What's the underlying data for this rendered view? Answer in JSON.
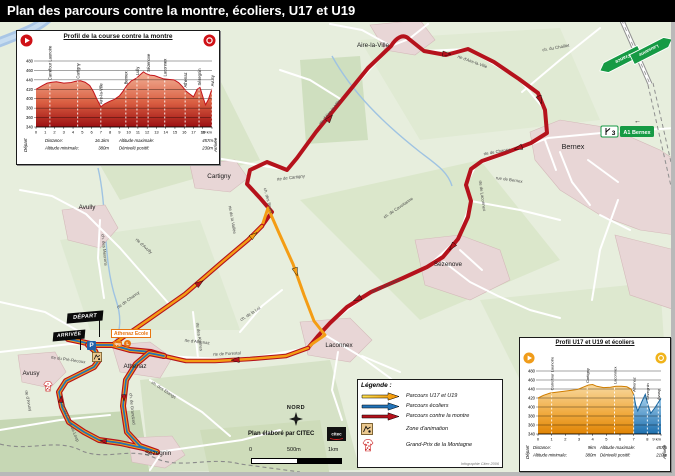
{
  "title": "Plan des parcours contre la montre, écoliers, U17 et U19",
  "colors": {
    "route_red": "#b5121c",
    "route_orange": "#f49d15",
    "route_blue": "#2273b8",
    "sign_green": "#169a44",
    "village_fill": "#e8d6d6",
    "water": "#a9c6e6"
  },
  "map": {
    "villages": [
      {
        "name": "Aire-la-Ville",
        "x": 373,
        "y": 47
      },
      {
        "name": "Bernex",
        "x": 573,
        "y": 149,
        "size": 7.2
      },
      {
        "name": "Cartigny",
        "x": 219,
        "y": 178
      },
      {
        "name": "Avully",
        "x": 87,
        "y": 209
      },
      {
        "name": "Sézenove",
        "x": 448,
        "y": 266
      },
      {
        "name": "Laconnex",
        "x": 339,
        "y": 347
      },
      {
        "name": "Athenaz",
        "x": 135,
        "y": 368
      },
      {
        "name": "Avusy",
        "x": 31,
        "y": 375
      },
      {
        "name": "Sézegnin",
        "x": 158,
        "y": 455
      }
    ],
    "road_labels": [
      {
        "text": "rte d'Aire-la-Ville",
        "x": 331,
        "y": 113,
        "rot": -50
      },
      {
        "text": "rte d'Aire-la-Ville",
        "x": 472,
        "y": 63,
        "rot": 20
      },
      {
        "text": "ch. du Chaillet",
        "x": 556,
        "y": 49,
        "rot": -10
      },
      {
        "text": "rte de Chancy",
        "x": 497,
        "y": 153,
        "rot": -10
      },
      {
        "text": "rue de Bernex",
        "x": 509,
        "y": 181,
        "rot": 8
      },
      {
        "text": "rte de Laconnex",
        "x": 481,
        "y": 196,
        "rot": 82
      },
      {
        "text": "rte de Laconnex",
        "x": 386,
        "y": 287,
        "rot": -24
      },
      {
        "text": "rte de Cartigny",
        "x": 291,
        "y": 179,
        "rot": -7
      },
      {
        "text": "ch. des Bruex",
        "x": 267,
        "y": 201,
        "rot": 75
      },
      {
        "text": "rte de la Vallée",
        "x": 231,
        "y": 220,
        "rot": 80
      },
      {
        "text": "ch. de Cavoitanne",
        "x": 399,
        "y": 209,
        "rot": -34
      },
      {
        "text": "rte de Chancy",
        "x": 129,
        "y": 301,
        "rot": -36
      },
      {
        "text": "rte d'Avully",
        "x": 143,
        "y": 247,
        "rot": 42
      },
      {
        "text": "ch. des Meurons",
        "x": 103,
        "y": 250,
        "rot": 84
      },
      {
        "text": "rte d'Athenaz",
        "x": 197,
        "y": 343,
        "rot": 6
      },
      {
        "text": "rte de Forestal",
        "x": 227,
        "y": 355,
        "rot": -3
      },
      {
        "text": "ch. de la Loi",
        "x": 251,
        "y": 315,
        "rot": -33
      },
      {
        "text": "rte des Abimes",
        "x": 198,
        "y": 337,
        "rot": 82
      },
      {
        "text": "ch. de Grandzod",
        "x": 131,
        "y": 409,
        "rot": 84
      },
      {
        "text": "rte du Creux-du-Loup",
        "x": 69,
        "y": 423,
        "rot": 68
      },
      {
        "text": "rte d'Avusy",
        "x": 27,
        "y": 401,
        "rot": 78
      },
      {
        "text": "ch. des Etangs",
        "x": 163,
        "y": 391,
        "rot": 33
      },
      {
        "text": "rte du Pré-Recoux",
        "x": 68,
        "y": 361,
        "rot": 8
      }
    ],
    "signs": {
      "france": "France",
      "lausanne": "Lausanne",
      "exit_number": "3",
      "exit_label": "A1 Bernex"
    },
    "icons": {
      "left_arrow": "←"
    },
    "north_label": "NORD",
    "credit": "Plan élaboré par CITEC",
    "logo_text": "citec",
    "scale": {
      "zero": "0",
      "mid": "500m",
      "end": "1km"
    },
    "start_flag": "DÉPART",
    "finish_flag": "ARRIVÉE",
    "school": {
      "name": "Athenaz Ecole",
      "tpg": "tpg",
      "line": "L"
    },
    "parking_label": "P",
    "caption": "Infographie Citec 2006"
  },
  "legend": {
    "title": "Légende :",
    "items": [
      {
        "label": "Parcours U17 et U19",
        "color": "orange",
        "swatch": "arrow"
      },
      {
        "label": "Parcours écoliers",
        "color": "blue",
        "swatch": "arrow"
      },
      {
        "label": "Parcours contre la montre",
        "color": "red",
        "swatch": "arrow"
      },
      {
        "label": "Zone d'animation",
        "swatch": "zone-icon"
      },
      {
        "label": "Grand-Prix de la Montagne",
        "swatch": "jersey-icon"
      }
    ]
  },
  "chart_data": [
    {
      "type": "area",
      "title": "Profil de la course contre la montre",
      "x_unit": "km",
      "xlim": [
        0,
        19
      ],
      "ylim": [
        340,
        480
      ],
      "yticks": [
        340,
        360,
        380,
        400,
        420,
        440,
        460,
        480
      ],
      "fill": "red",
      "grid": true,
      "points": [
        [
          0,
          420
        ],
        [
          0.7,
          428
        ],
        [
          1.2,
          433
        ],
        [
          1.7,
          435
        ],
        [
          2.2,
          436
        ],
        [
          3,
          433
        ],
        [
          3.7,
          434
        ],
        [
          4.3,
          437
        ],
        [
          4.8,
          438
        ],
        [
          5.3,
          435
        ],
        [
          5.8,
          428
        ],
        [
          6.2,
          415
        ],
        [
          6.6,
          398
        ],
        [
          7,
          383
        ],
        [
          7.4,
          389
        ],
        [
          7.9,
          394
        ],
        [
          8.5,
          399
        ],
        [
          9,
          406
        ],
        [
          9.4,
          416
        ],
        [
          9.8,
          428
        ],
        [
          10.3,
          438
        ],
        [
          10.8,
          443
        ],
        [
          11.2,
          450
        ],
        [
          11.6,
          457
        ],
        [
          11.9,
          453
        ],
        [
          12.3,
          450
        ],
        [
          12.8,
          449
        ],
        [
          13.2,
          446
        ],
        [
          13.8,
          442
        ],
        [
          14.3,
          441
        ],
        [
          14.9,
          440
        ],
        [
          15.4,
          434
        ],
        [
          15.8,
          426
        ],
        [
          16.2,
          416
        ],
        [
          16.6,
          410
        ],
        [
          17,
          404
        ],
        [
          17.4,
          420
        ],
        [
          17.7,
          424
        ],
        [
          18,
          405
        ],
        [
          18.3,
          387
        ],
        [
          18.6,
          398
        ],
        [
          19,
          421
        ]
      ],
      "landmarks": [
        [
          1.5,
          "Carrefour Launoire"
        ],
        [
          4.5,
          "Cartigny"
        ],
        [
          7,
          "Aire-la-Ville"
        ],
        [
          9.7,
          "Bernex"
        ],
        [
          10.9,
          "Lully"
        ],
        [
          12.1,
          "Sézenove"
        ],
        [
          13.9,
          "Laconnex"
        ],
        [
          16.1,
          "Athenaz"
        ],
        [
          17.6,
          "Sézegnin"
        ],
        [
          19,
          "Avusy"
        ]
      ],
      "start_label": "Départ",
      "end_label": "Arrivée",
      "info": [
        {
          "label": "Distance:",
          "value": "16.1km"
        },
        {
          "label": "Altitude minimale:",
          "value": "380m"
        },
        {
          "label": "Altitude maximale:",
          "value": "457m"
        },
        {
          "label": "Dénivelé positif:",
          "value": "230m"
        }
      ]
    },
    {
      "type": "area",
      "title": "Profil U17 et U19 et écoliers",
      "x_unit": "km",
      "xlim": [
        0,
        9
      ],
      "ylim": [
        340,
        480
      ],
      "yticks": [
        340,
        360,
        380,
        400,
        420,
        440,
        460,
        480
      ],
      "segments": [
        {
          "to_km": 7,
          "fill": "orange"
        },
        {
          "to_km": 9,
          "fill": "blue"
        }
      ],
      "grid": true,
      "points": [
        [
          0,
          420
        ],
        [
          0.4,
          426
        ],
        [
          0.9,
          431
        ],
        [
          1.4,
          433
        ],
        [
          1.9,
          435
        ],
        [
          2.4,
          437
        ],
        [
          2.9,
          439
        ],
        [
          3.3,
          444
        ],
        [
          3.7,
          449
        ],
        [
          4,
          450
        ],
        [
          4.3,
          446
        ],
        [
          4.8,
          443
        ],
        [
          5.3,
          444
        ],
        [
          5.7,
          446
        ],
        [
          6.1,
          446
        ],
        [
          6.5,
          445
        ],
        [
          6.8,
          440
        ],
        [
          7,
          428
        ],
        [
          7.15,
          404
        ],
        [
          7.3,
          391
        ],
        [
          7.6,
          412
        ],
        [
          7.85,
          428
        ],
        [
          8.05,
          404
        ],
        [
          8.25,
          386
        ],
        [
          8.55,
          398
        ],
        [
          8.8,
          410
        ],
        [
          9,
          419
        ]
      ],
      "landmarks": [
        [
          1,
          "Carrefour Launoire"
        ],
        [
          3.6,
          "Cartigny"
        ],
        [
          5.6,
          "Laconnex"
        ],
        [
          7,
          "Athenaz"
        ],
        [
          8,
          "Sézegnin"
        ],
        [
          8.8,
          "Avusy"
        ]
      ],
      "start_label": "Départ",
      "end_label": "Arrivée",
      "info": [
        {
          "label": "Distance:",
          "value": "9km"
        },
        {
          "label": "Altitude minimale:",
          "value": "380m"
        },
        {
          "label": "Altitude maximale:",
          "value": "457m"
        },
        {
          "label": "Dénivelé positif:",
          "value": "210m"
        }
      ]
    }
  ]
}
